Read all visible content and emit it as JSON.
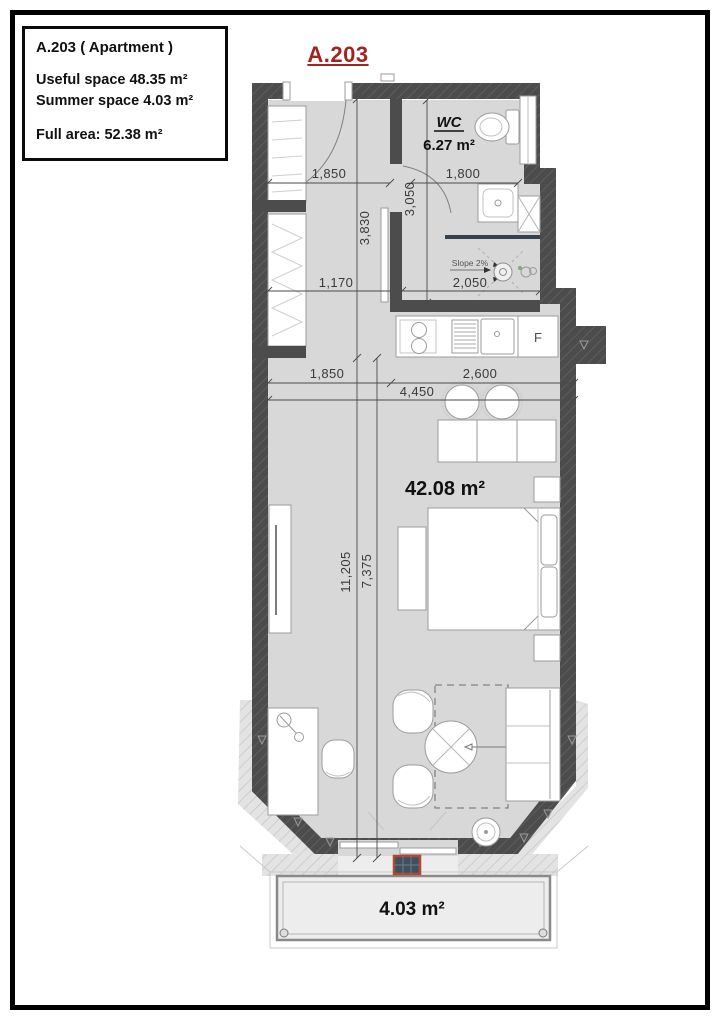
{
  "info_box": {
    "title": "A.203 ( Apartment )",
    "useful": "Useful space 48.35 m²",
    "summer": "Summer space 4.03 m²",
    "full": "Full area: 52.38 m²"
  },
  "plan": {
    "unit_label": "A.203",
    "accent_red": "#a22421",
    "wall_color": "#4c4c4c",
    "rooms": {
      "wc_name": "WC",
      "wc_area": "6.27 m²",
      "main_area": "42.08 m²",
      "balcony_area": "4.03 m²"
    },
    "kitchen": {
      "fridge_label": "F"
    },
    "slope_label": "Slope 2%",
    "dimensions": {
      "top_left": "1,850",
      "top_right": "1,800",
      "hall_height": "3,830",
      "wc_height": "3,050",
      "hall_width": "1,170",
      "wc_width": "2,050",
      "mid_left": "1,850",
      "kitchen_width": "2,600",
      "room_width": "4,450",
      "total_height": "11,205",
      "room_height": "7,375"
    }
  }
}
